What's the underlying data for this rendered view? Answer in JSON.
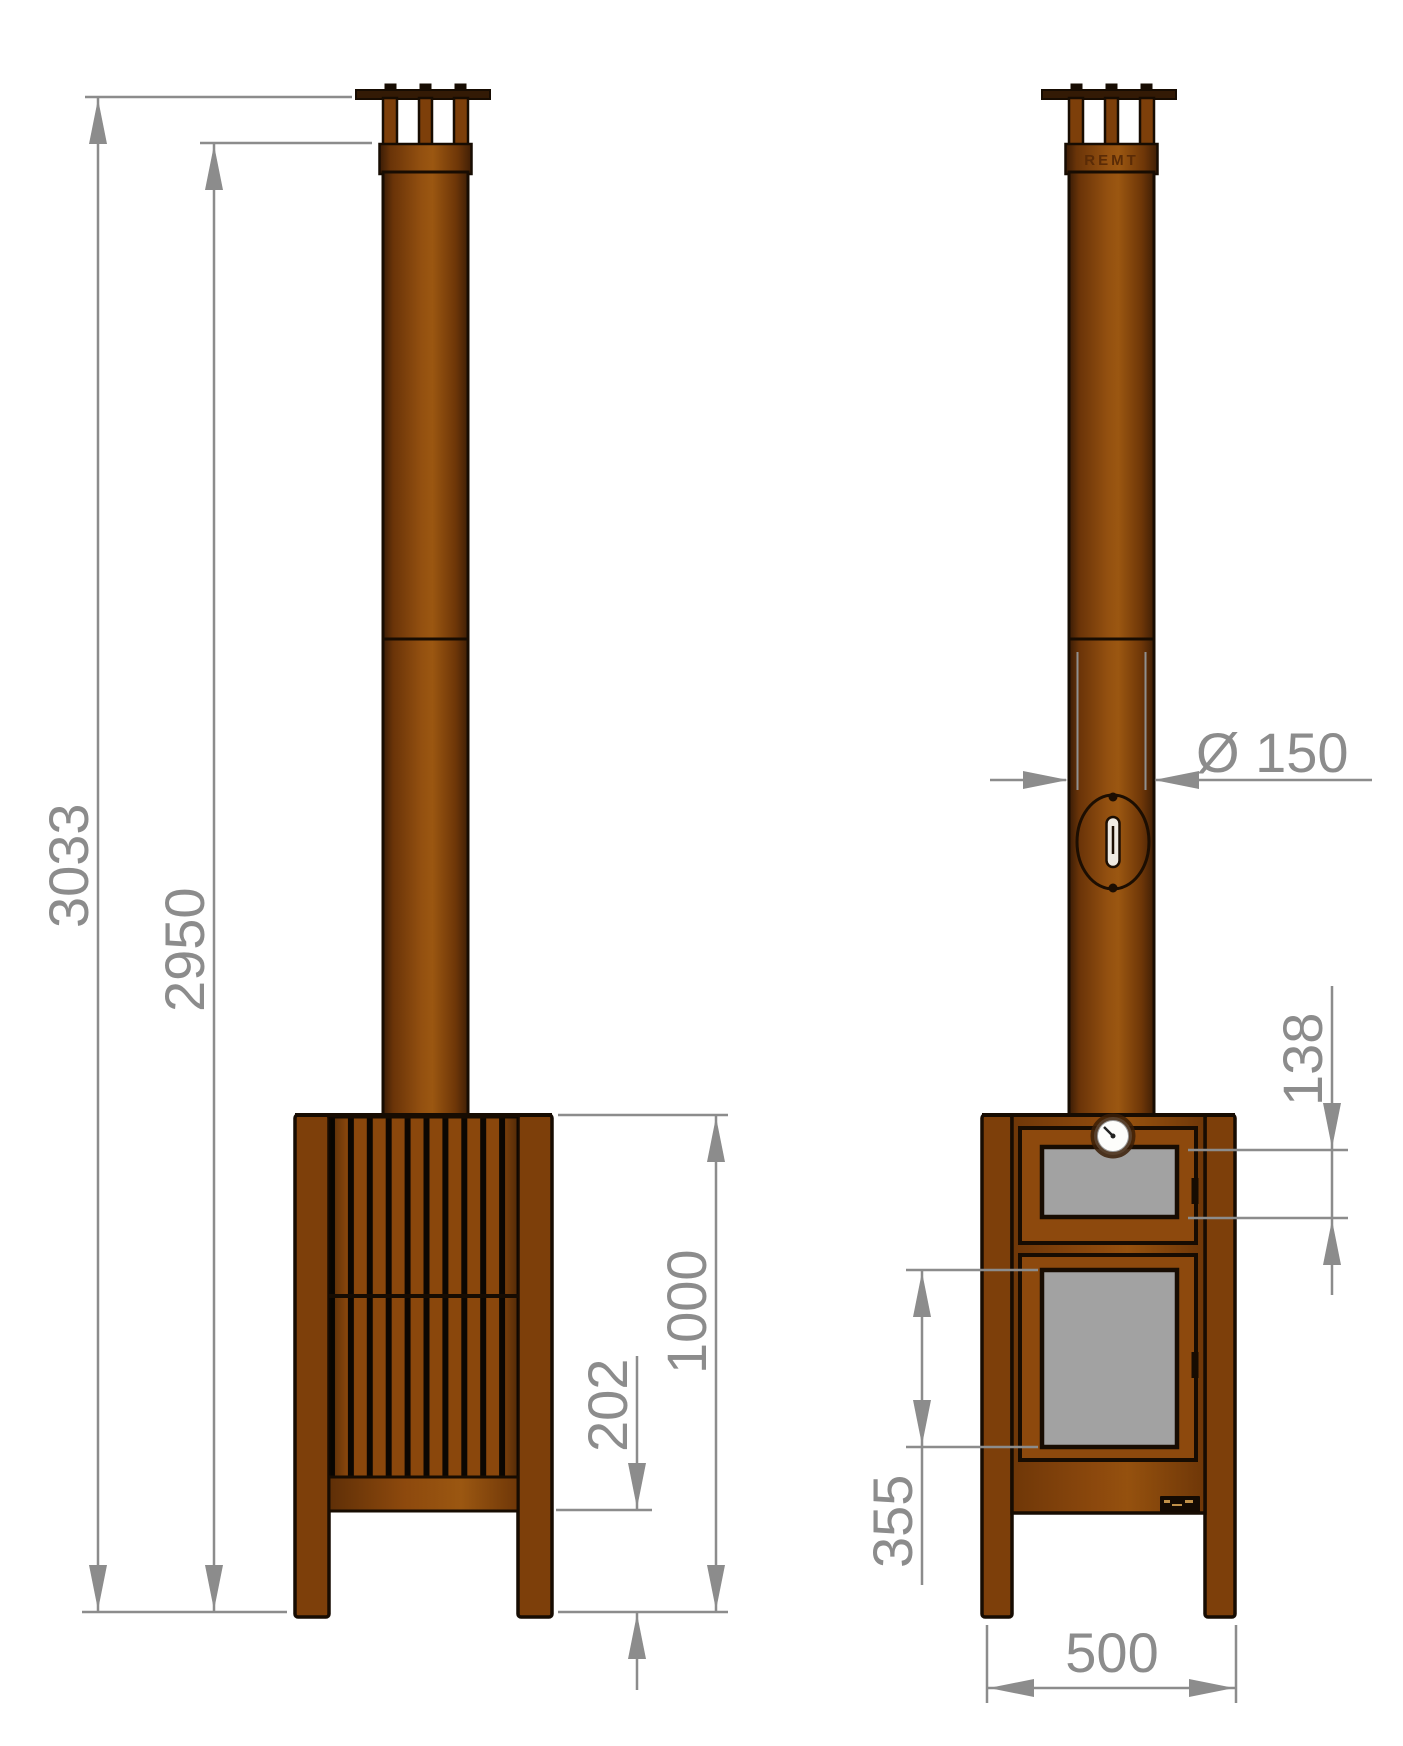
{
  "dimensions": {
    "side": {
      "overall_height": "3033",
      "flue_top_height": "2950",
      "body_height": "1000",
      "ground_clearance": "202"
    },
    "front": {
      "flue_diameter": "Ø 150",
      "upper_glass_height": "138",
      "lower_glass_height": "355",
      "body_width": "500"
    }
  },
  "branding": {
    "embossed_text": "REMT"
  },
  "colors": {
    "corten_brown": "#8a470c",
    "corten_dark": "#5e2e08",
    "outline": "#170c02",
    "glass_grey": "#a2a2a2",
    "dimension_grey": "#8c8c8c",
    "background": "#ffffff"
  }
}
